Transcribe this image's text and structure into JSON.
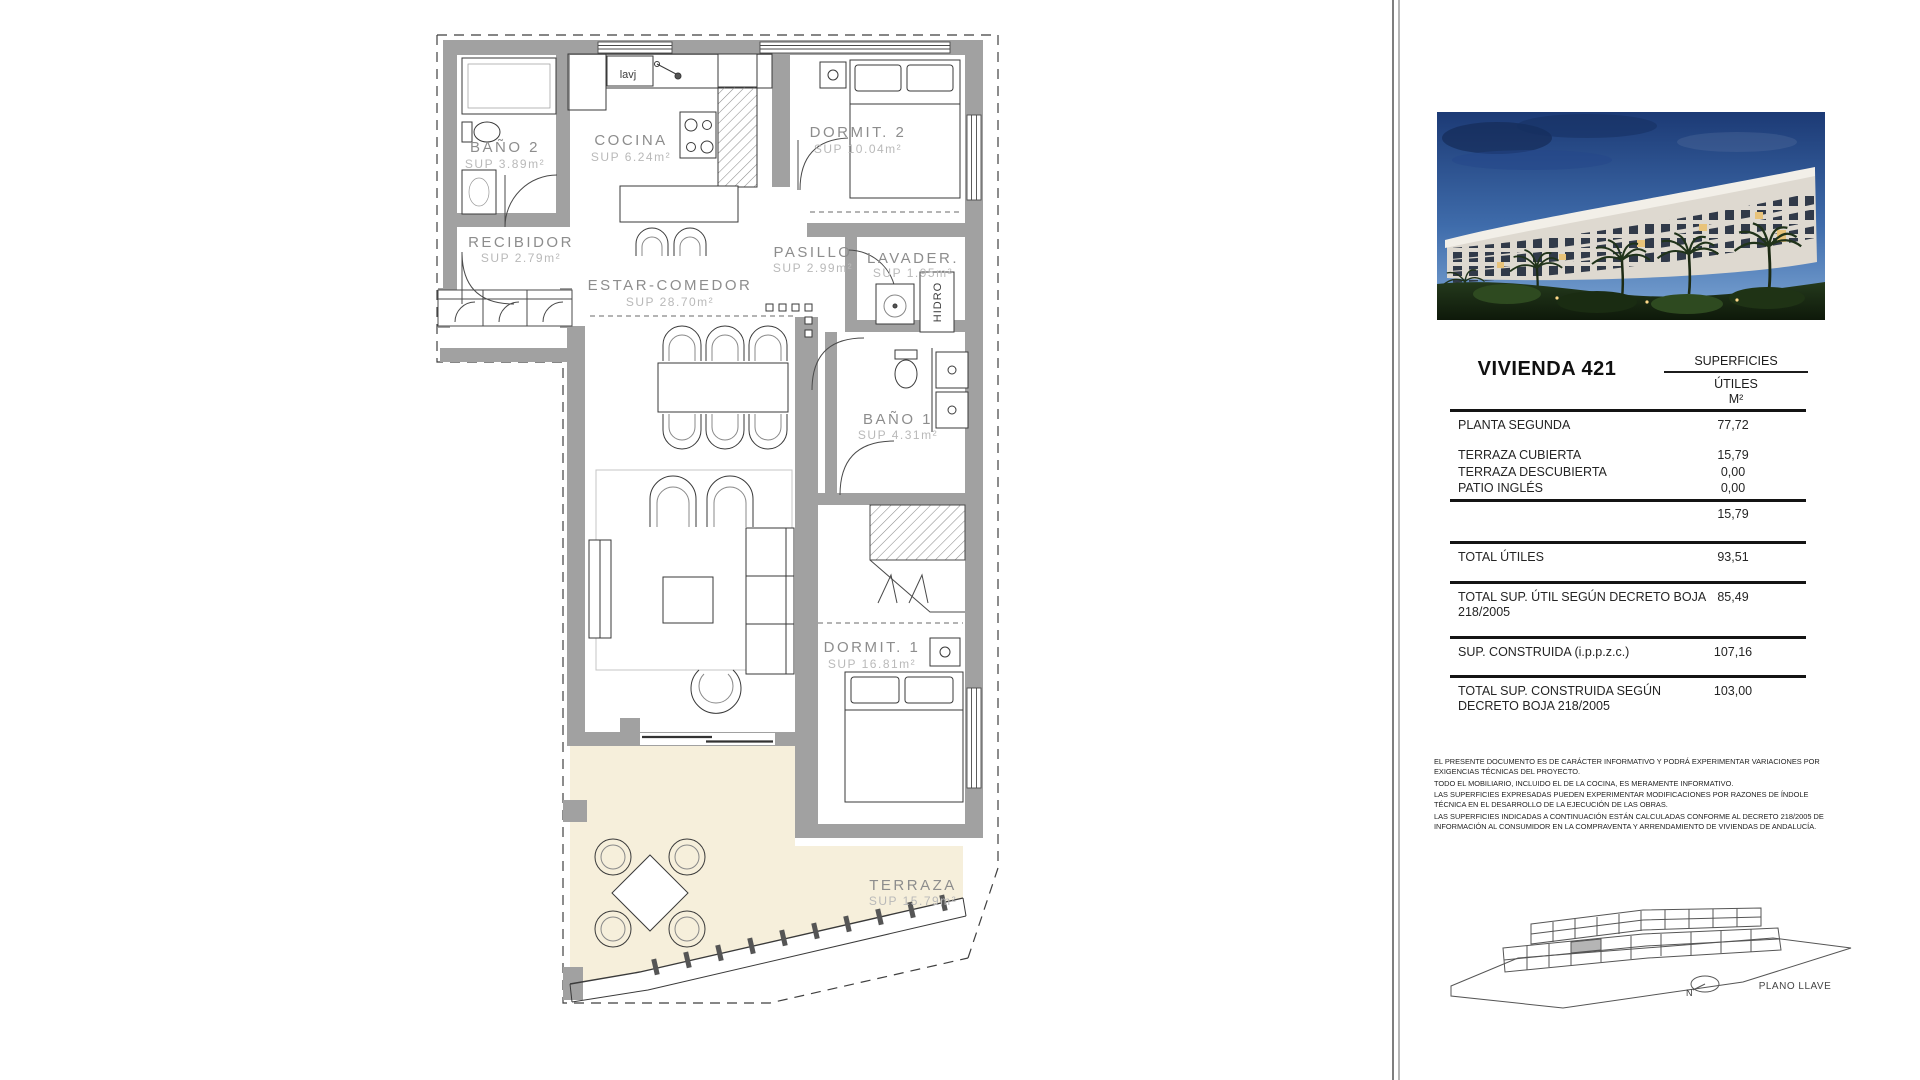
{
  "plan": {
    "rooms": [
      {
        "id": "bano2",
        "name": "BAÑO 2",
        "sup": "SUP 3.89m²"
      },
      {
        "id": "cocina",
        "name": "COCINA",
        "sup": "SUP 6.24m²"
      },
      {
        "id": "dormit2",
        "name": "DORMIT. 2",
        "sup": "SUP 10.04m²"
      },
      {
        "id": "recibidor",
        "name": "RECIBIDOR",
        "sup": "SUP 2.79m²"
      },
      {
        "id": "estar",
        "name": "ESTAR-COMEDOR",
        "sup": "SUP 28.70m²"
      },
      {
        "id": "pasillo",
        "name": "PASILLO",
        "sup": "SUP 2.99m²"
      },
      {
        "id": "lavadero",
        "name": "LAVADER.",
        "sup": "SUP 1.95m²"
      },
      {
        "id": "bano1",
        "name": "BAÑO 1",
        "sup": "SUP 4.31m²"
      },
      {
        "id": "dormit1",
        "name": "DORMIT. 1",
        "sup": "SUP 16.81m²"
      },
      {
        "id": "terraza",
        "name": "TERRAZA",
        "sup": "SUP 15.79m²"
      }
    ],
    "labels": {
      "sink": "lavj",
      "hidro": "HIDRO"
    }
  },
  "panel": {
    "title": "VIVIENDA 421",
    "table": {
      "col_header": "SUPERFICIES",
      "col_sub1": "ÚTILES",
      "col_sub2": "M²",
      "rows": [
        {
          "label": "PLANTA SEGUNDA",
          "value": "77,72"
        },
        {
          "label": "TERRAZA CUBIERTA",
          "value": "15,79"
        },
        {
          "label": "TERRAZA DESCUBIERTA",
          "value": "0,00"
        },
        {
          "label": "PATIO INGLÉS",
          "value": "0,00"
        },
        {
          "label": "",
          "value": "15,79"
        },
        {
          "label": "TOTAL ÚTILES",
          "value": "93,51"
        },
        {
          "label": "TOTAL SUP. ÚTIL SEGÚN DECRETO BOJA 218/2005",
          "value": "85,49"
        },
        {
          "label": "SUP. CONSTRUIDA (i.p.p.z.c.)",
          "value": "107,16"
        },
        {
          "label": "TOTAL SUP. CONSTRUIDA SEGÚN DECRETO BOJA 218/2005",
          "value": "103,00"
        }
      ]
    },
    "disclaimer": [
      "EL PRESENTE DOCUMENTO ES DE CARÁCTER INFORMATIVO Y PODRÁ EXPERIMENTAR VARIACIONES POR EXIGENCIAS TÉCNICAS DEL PROYECTO.",
      "TODO EL MOBILIARIO, INCLUIDO EL DE LA COCINA, ES MERAMENTE INFORMATIVO.",
      "LAS SUPERFICIES EXPRESADAS PUEDEN EXPERIMENTAR MODIFICACIONES POR RAZONES DE ÍNDOLE TÉCNICA EN EL DESARROLLO DE LA EJECUCIÓN DE LAS OBRAS.",
      "LAS SUPERFICIES INDICADAS A CONTINUACIÓN ESTÁN CALCULADAS CONFORME AL DECRETO 218/2005 DE INFORMACIÓN AL CONSUMIDOR EN LA COMPRAVENTA Y ARRENDAMIENTO DE VIVIENDAS DE ANDALUCÍA."
    ],
    "keyplan": {
      "label": "PLANO LLAVE",
      "north": "N"
    }
  },
  "colors": {
    "wall": "#a1a1a1",
    "terrace": "#f6efdb",
    "accent_line": "#141414"
  }
}
